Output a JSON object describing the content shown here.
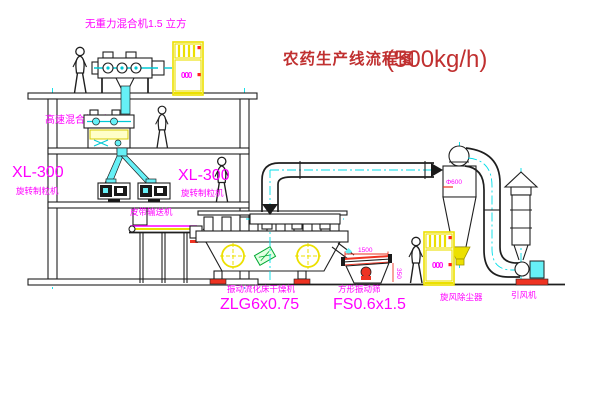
{
  "title": {
    "name": "农药生产线流程图",
    "capacity": "(500kg/h)"
  },
  "labels": {
    "gravity_mixer": "无重力混合机1.5 立方",
    "high_speed_mixer": "高速混合机3立方",
    "granulator_left_model": "XL-300",
    "granulator_left_name": "旋转制粒机",
    "granulator_right_model": "XL-300",
    "granulator_right_name": "旋转制粒机",
    "belt_conveyor": "皮带输送机",
    "dryer_name": "振动流化床干燥机",
    "dryer_model": "ZLG6x0.75",
    "screen_name": "方形振动筛",
    "screen_model": "FS0.6x1.5",
    "cyclone": "旋风除尘器",
    "fan": "引风机"
  },
  "dimensions": {
    "cyclone_diameter": "Φ600",
    "screen_length": "1500",
    "screen_height": "350",
    "cabinet_display": "000"
  },
  "colors": {
    "label_magenta": "#ff00ff",
    "title_red": "#c03030",
    "centerline_cyan": "#00dde8",
    "cabinet_yellow": "#ece000",
    "accent_red": "#ee3322",
    "pipe_cyan": "#66f0f6",
    "tag_green": "#00aa33"
  }
}
